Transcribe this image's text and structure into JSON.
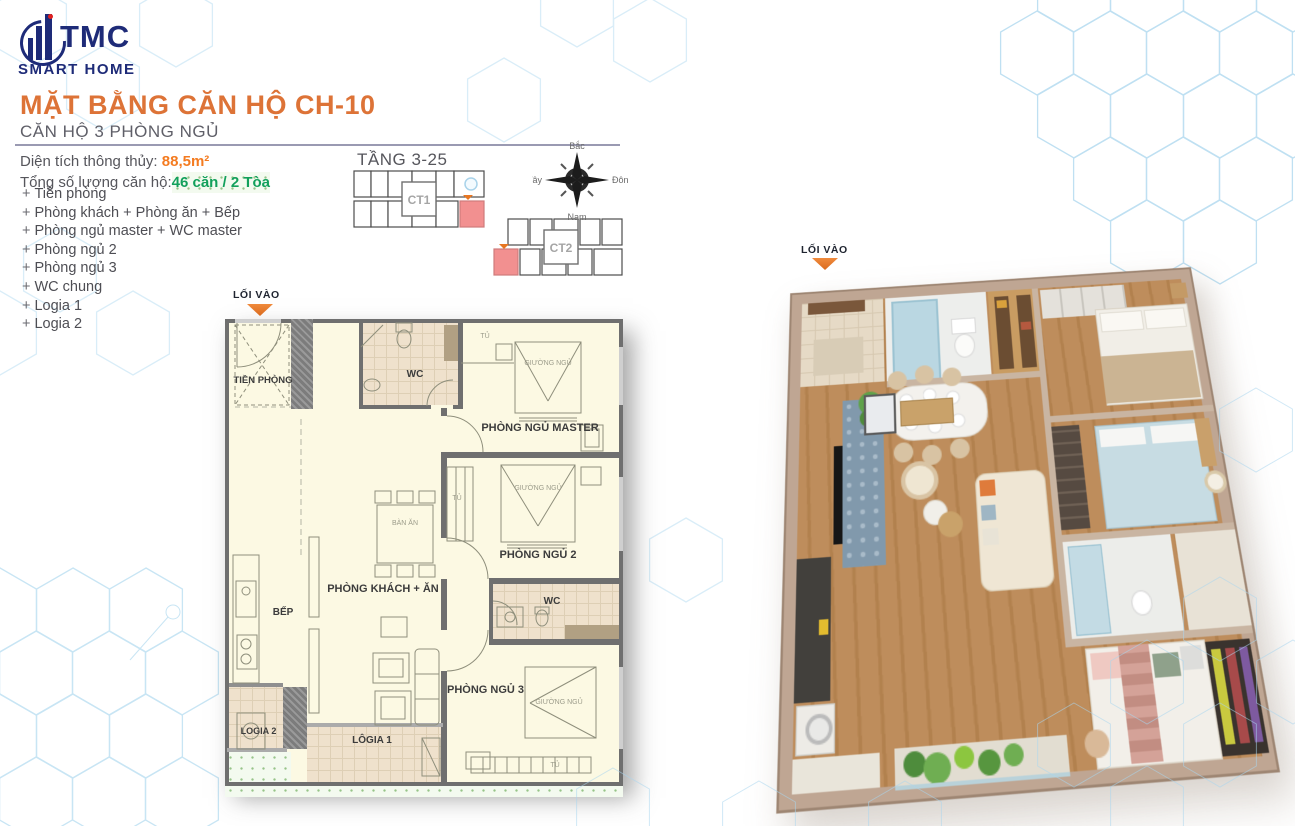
{
  "header": {
    "brand": "TMC",
    "brand_tagline": "SMART HOME",
    "title": "MẶT BẰNG CĂN HỘ CH-10",
    "subtitle": "CĂN HỘ 3 PHÒNG NGỦ"
  },
  "summary": {
    "area_label": "Diện tích thông thủy:",
    "area_value": "88,5m²",
    "units_label": "Tổng số lượng căn hộ:",
    "units_value": "46 căn / 2 Tòa",
    "bullet": "+",
    "room_list": [
      "Tiền phòng",
      "Phòng khách + Phòng ăn + Bếp",
      "Phòng ngủ master + WC master",
      "Phòng ngủ 2",
      "Phòng ngủ 3",
      "WC chung",
      "Logia 1",
      "Logia 2"
    ]
  },
  "locator": {
    "floor_label": "TẦNG 3-25",
    "tower1": "CT1",
    "tower2": "CT2",
    "highlight_color": "#F29090"
  },
  "compass": {
    "north": "Bắc",
    "east": "Đông",
    "south": "Nam",
    "west": "Tây"
  },
  "plan2d": {
    "entrance_label": "LỐI VÀO",
    "hall": "TIỀN PHÒNG",
    "wc": "WC",
    "master": "PHÒNG NGỦ MASTER",
    "bedroom2": "PHÒNG NGỦ 2",
    "bedroom3": "PHÒNG NGỦ 3",
    "living": "PHÒNG KHÁCH + ĂN",
    "kitchen": "BẾP",
    "logia1": "LÔGIA 1",
    "logia2": "LOGIA 2",
    "bed_label": "GIƯỜNG NGỦ",
    "wardrobe_label": "TỦ",
    "dining_label": "BÀN ĂN"
  },
  "plan3d": {
    "entrance_label": "LỐI VÀO"
  },
  "colors": {
    "brand_navy": "#1E2B78",
    "accent_orange": "#DD7337",
    "accent_green": "#12A05B",
    "highlight_pink": "#F29090",
    "hex_line": "#BFE0F2",
    "wall_gray": "#6F6F6F",
    "plan_cream": "#FCF9E3"
  }
}
